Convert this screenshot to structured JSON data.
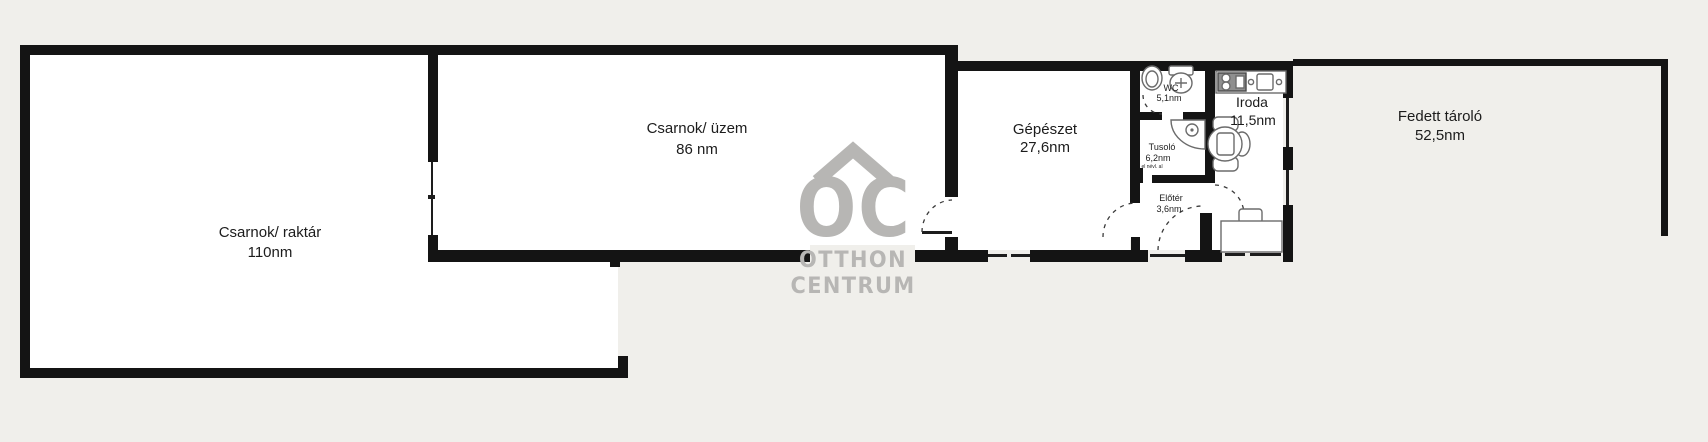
{
  "plan": {
    "rooms": {
      "raktar": {
        "name": "Csarnok/ raktár",
        "area": "110nm"
      },
      "uzem": {
        "name": "Csarnok/ üzem",
        "area": "86 nm"
      },
      "gepeszet": {
        "name": "Gépészet",
        "area": "27,6nm"
      },
      "wc": {
        "name": "WC",
        "area": "5,1nm"
      },
      "tusolo": {
        "name": "Tusoló",
        "area": "6,2nm",
        "note": "el névl. al"
      },
      "eloter": {
        "name": "Előtér",
        "area": "3,6nm"
      },
      "iroda": {
        "name": "Iroda",
        "area": "11,5nm"
      },
      "fedett": {
        "name": "Fedett tároló",
        "area": "52,5nm"
      }
    },
    "watermark": {
      "monogram": "OC",
      "line1": "OTTHON",
      "line2": "CENTRUM"
    }
  },
  "colors": {
    "background": "#f0efeb",
    "wall": "#141414",
    "floor": "#ffffff",
    "watermark": "#b7b6b4",
    "fixture": "#6b6b6b",
    "ink": "#1c1c1c"
  }
}
